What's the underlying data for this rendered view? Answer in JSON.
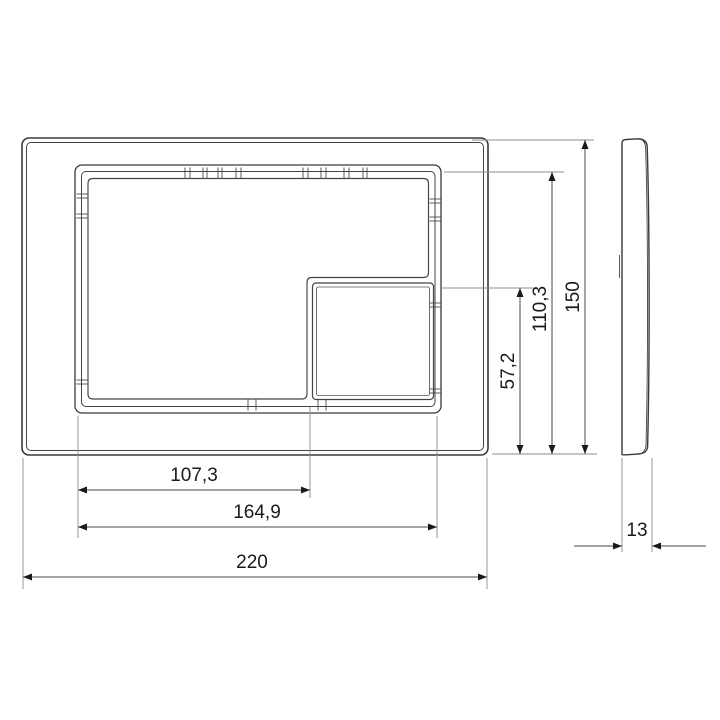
{
  "drawing": {
    "dimensions": {
      "overall_width": "220",
      "opening_width": "164,9",
      "large_button_width": "107,3",
      "overall_height": "150",
      "opening_height": "110,3",
      "small_button_height": "57,2",
      "thickness": "13"
    },
    "colors": {
      "background": "#ffffff",
      "part_outline": "#3a3a3a",
      "dimension_line": "#4a4a4a",
      "extension_line": "#8c8c8c",
      "text": "#1a1a1a"
    }
  }
}
